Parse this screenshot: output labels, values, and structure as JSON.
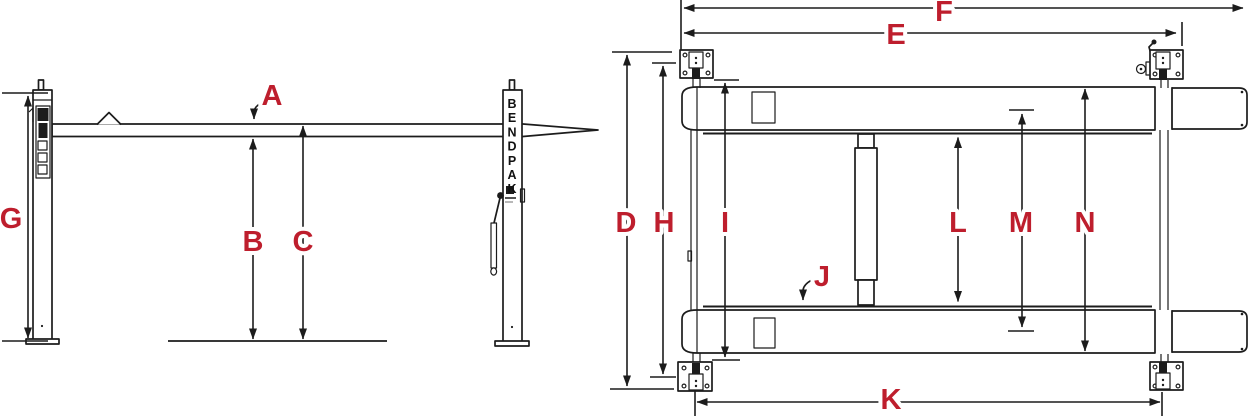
{
  "diagram": {
    "description": "BendPak four-post car lift dimension drawing: side elevation (left) and plan view (right)",
    "accent_color": "#be1e2d",
    "line_color": "#1c1c1c",
    "background_color": "#ffffff",
    "brand": "BENDPAK"
  },
  "side_view": {
    "labels": {
      "A": "A",
      "B": "B",
      "C": "C",
      "G": "G"
    }
  },
  "plan_view": {
    "labels": {
      "D": "D",
      "E": "E",
      "F": "F",
      "H": "H",
      "I": "I",
      "J": "J",
      "K": "K",
      "L": "L",
      "M": "M",
      "N": "N"
    }
  }
}
